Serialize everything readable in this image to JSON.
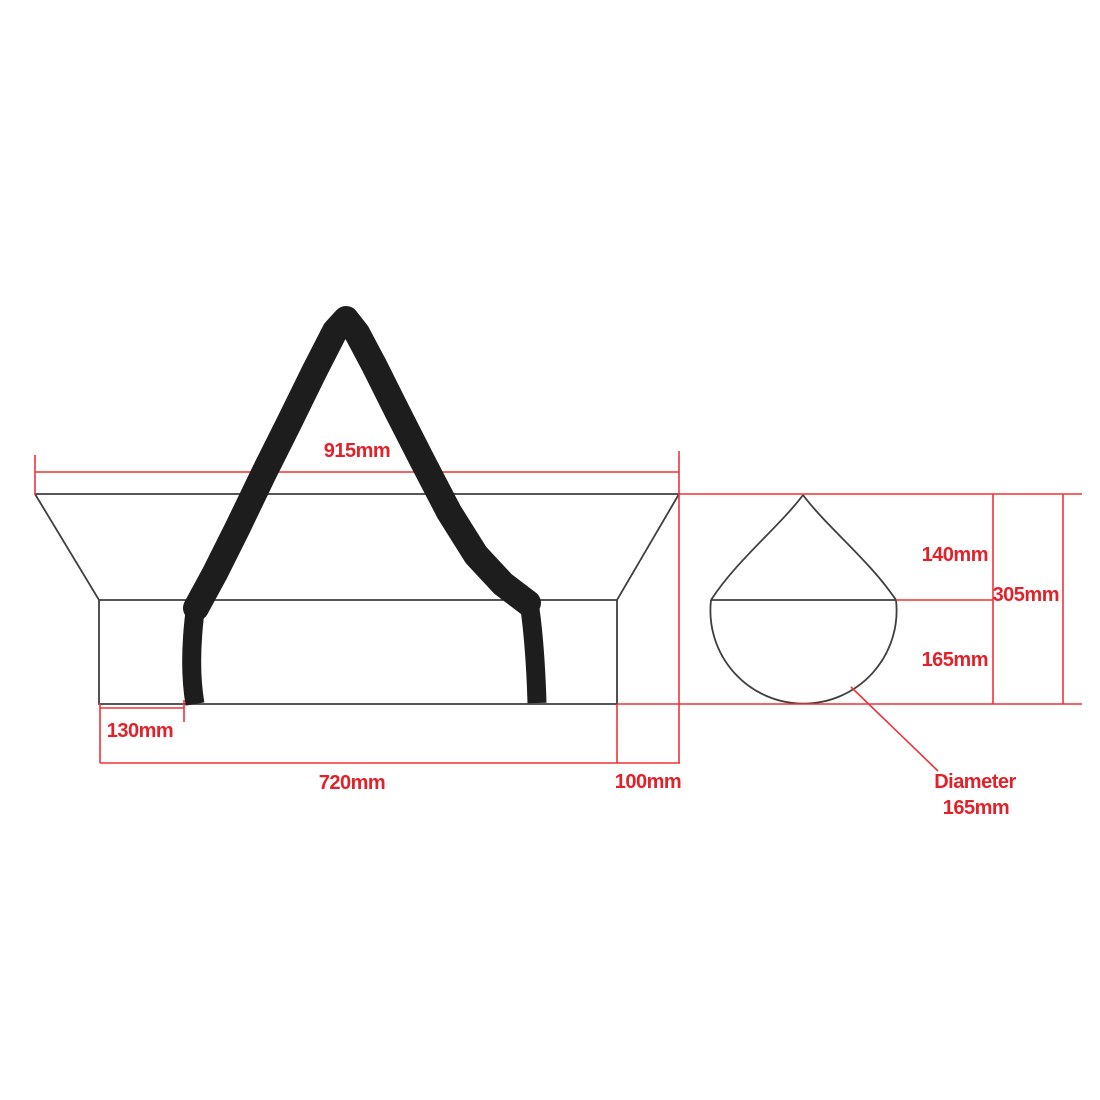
{
  "colors": {
    "dimension_text": "#e2222a",
    "dimension_line": "#ee3237",
    "outline": "#3f3f3f",
    "strap": "#1d1d1d",
    "background": "#ffffff"
  },
  "side_view": {
    "top_width_label": "915mm",
    "strap_inset_label": "130mm",
    "body_length_label": "720mm",
    "taper_length_label": "100mm"
  },
  "end_view": {
    "cone_height_label": "140mm",
    "overall_height_label": "305mm",
    "lower_height_label": "165mm",
    "diameter_label_line1": "Diameter",
    "diameter_label_line2": "165mm"
  }
}
